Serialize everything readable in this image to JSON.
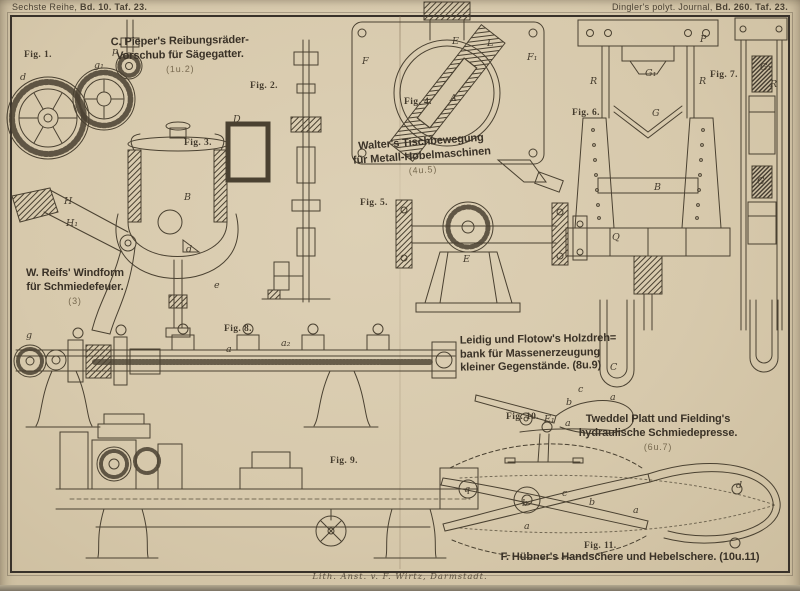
{
  "colors": {
    "paper": "#d7c9ac",
    "ink": "#3a3227",
    "ink_light": "#77694f",
    "frame": "#39322a"
  },
  "header": {
    "left_pre": "Sechste Reihe, ",
    "left_bold": "Bd. 10. Taf. 23.",
    "right_pre": "Dingler's polyt. Journal, ",
    "right_bold": "Bd. 260. Taf. 23."
  },
  "imprint": "Lith. Anst. v. F. Wirtz, Darmstadt.",
  "titles": {
    "pieper": {
      "line1": "C. Pieper's Reibungsräder-",
      "line2": "Vorschub für Sägegatter.",
      "figs": "(1u.2)"
    },
    "walter": {
      "line1": "Walter's Tischbewegung",
      "line2": "für Metall-Hobelmaschinen",
      "figs": "(4u.5)"
    },
    "reifs": {
      "line1": "W. Reifs' Windform",
      "line2": "für Schmiedefeuer.",
      "figs": "(3)"
    },
    "leidig": {
      "line1": "Leidig und Flotow's Holzdreh=",
      "line2": "bank für Massenerzeugung",
      "line3": "kleiner Gegenstände. (8u.9)"
    },
    "tweddel": {
      "line1": "Tweddel Platt und Fielding's",
      "line2": "hydraulische Schmiedepresse.",
      "figs": "(6u.7)"
    },
    "huebner": {
      "line": "F. Hübner's Handschere und Hebelschere. (10u.11)"
    }
  },
  "fig_labels": [
    {
      "text": "Fig. 1.",
      "x": 24,
      "y": 50
    },
    {
      "text": "Fig. 2.",
      "x": 250,
      "y": 81
    },
    {
      "text": "Fig. 3.",
      "x": 184,
      "y": 138
    },
    {
      "text": "Fig. 4.",
      "x": 404,
      "y": 97
    },
    {
      "text": "Fig. 5.",
      "x": 360,
      "y": 198
    },
    {
      "text": "Fig. 6.",
      "x": 572,
      "y": 108
    },
    {
      "text": "Fig. 7.",
      "x": 710,
      "y": 70
    },
    {
      "text": "Fig. 8.",
      "x": 224,
      "y": 324
    },
    {
      "text": "Fig. 9.",
      "x": 330,
      "y": 456
    },
    {
      "text": "Fig. 10.",
      "x": 506,
      "y": 412
    },
    {
      "text": "Fig. 11.",
      "x": 584,
      "y": 541
    }
  ],
  "part_letters": [
    {
      "t": "d",
      "x": 20,
      "y": 72
    },
    {
      "t": "p",
      "x": 112,
      "y": 46
    },
    {
      "t": "g₁",
      "x": 94,
      "y": 60
    },
    {
      "t": "D",
      "x": 233,
      "y": 114
    },
    {
      "t": "B",
      "x": 184,
      "y": 192
    },
    {
      "t": "H",
      "x": 64,
      "y": 196
    },
    {
      "t": "H₁",
      "x": 66,
      "y": 218
    },
    {
      "t": "d",
      "x": 186,
      "y": 244
    },
    {
      "t": "e",
      "x": 214,
      "y": 280
    },
    {
      "t": "A",
      "x": 450,
      "y": 93
    },
    {
      "t": "E",
      "x": 452,
      "y": 36
    },
    {
      "t": "L",
      "x": 487,
      "y": 38
    },
    {
      "t": "F",
      "x": 362,
      "y": 56
    },
    {
      "t": "F₁",
      "x": 527,
      "y": 52
    },
    {
      "t": "E",
      "x": 463,
      "y": 254
    },
    {
      "t": "P",
      "x": 700,
      "y": 34
    },
    {
      "t": "R",
      "x": 590,
      "y": 76
    },
    {
      "t": "R",
      "x": 699,
      "y": 76
    },
    {
      "t": "G₁",
      "x": 645,
      "y": 68
    },
    {
      "t": "G",
      "x": 652,
      "y": 108
    },
    {
      "t": "B",
      "x": 654,
      "y": 182
    },
    {
      "t": "Q",
      "x": 612,
      "y": 232
    },
    {
      "t": "C",
      "x": 610,
      "y": 362
    },
    {
      "t": "G₁",
      "x": 760,
      "y": 62
    },
    {
      "t": "R",
      "x": 770,
      "y": 79
    },
    {
      "t": "G",
      "x": 757,
      "y": 176
    },
    {
      "t": "g",
      "x": 26,
      "y": 330
    },
    {
      "t": "a",
      "x": 226,
      "y": 344
    },
    {
      "t": "a₂",
      "x": 281,
      "y": 338
    },
    {
      "t": "q",
      "x": 464,
      "y": 484
    },
    {
      "t": "c",
      "x": 578,
      "y": 384
    },
    {
      "t": "b",
      "x": 566,
      "y": 397
    },
    {
      "t": "a",
      "x": 610,
      "y": 392
    },
    {
      "t": "E₁",
      "x": 544,
      "y": 414
    },
    {
      "t": "a",
      "x": 565,
      "y": 418
    },
    {
      "t": "b",
      "x": 522,
      "y": 498
    },
    {
      "t": "c",
      "x": 562,
      "y": 488
    },
    {
      "t": "b",
      "x": 589,
      "y": 497
    },
    {
      "t": "a",
      "x": 633,
      "y": 505
    },
    {
      "t": "a",
      "x": 524,
      "y": 521
    },
    {
      "t": "d",
      "x": 736,
      "y": 480
    }
  ]
}
